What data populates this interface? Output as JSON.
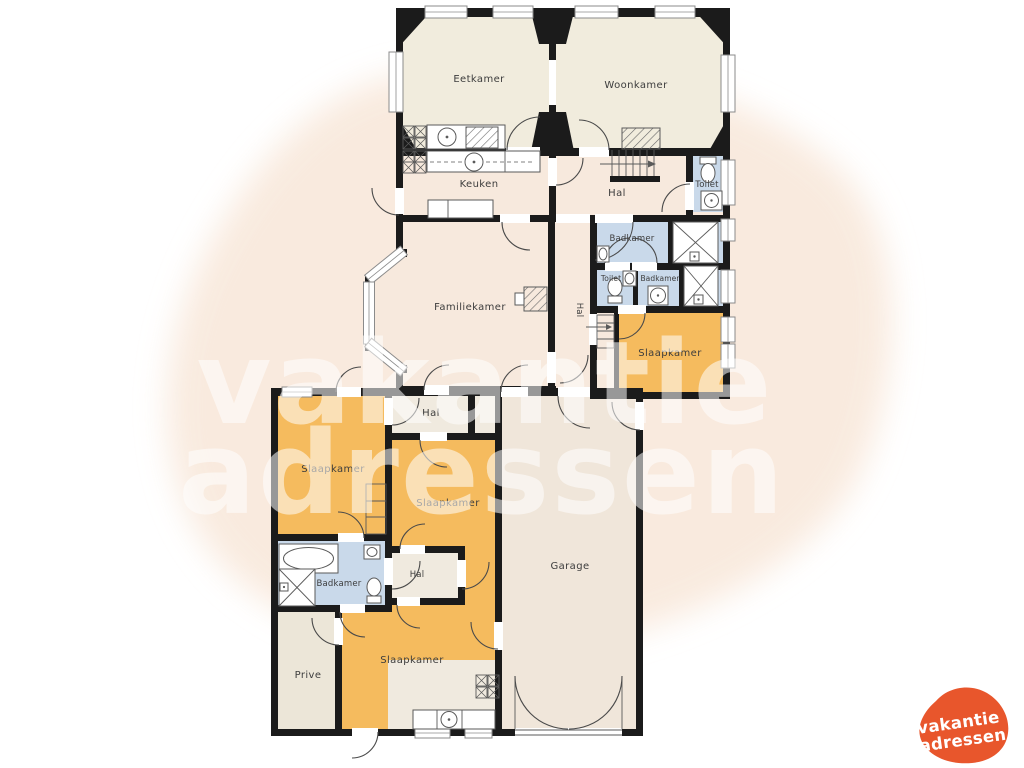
{
  "palette": {
    "wall": "#1b1b1b",
    "bedroom_orange": "#f5bb5e",
    "bathroom_blue": "#c9d9ea",
    "living_cream": "#f1ecdd",
    "living_pink": "#f7e9dd",
    "hall_light": "#f0eadf",
    "garage_tone": "#f0e6da",
    "private_tone": "#ece6d8",
    "label_color": "#3d3d3d",
    "blob_pink": "#f8e7d9",
    "logo_orange": "#e8562c"
  },
  "rooms": {
    "eetkamer": "Eetkamer",
    "woonkamer": "Woonkamer",
    "keuken": "Keuken",
    "hal_upper": "Hal",
    "toilet_upper": "Toilet",
    "badkamer_mid": "Badkamer",
    "toilet_mid": "Toilet",
    "badkamer_mid2": "Badkamer",
    "hal_corridor": "Hal",
    "slaapkamer_right": "Slaapkamer",
    "familiekamer": "Familiekamer",
    "hal_wing": "Hal",
    "slaapkamer_left": "Slaapkamer",
    "slaapkamer_center": "Slaapkamer",
    "badkamer_wing": "Badkamer",
    "hal_small": "Hal",
    "prive": "Prive",
    "slaapkamer_bottom": "Slaapkamer",
    "garage": "Garage"
  },
  "watermark": {
    "line1": "vakantie",
    "line2": "adressen"
  },
  "brand_logo": {
    "line1": "vakantie",
    "line2": "adressen"
  }
}
